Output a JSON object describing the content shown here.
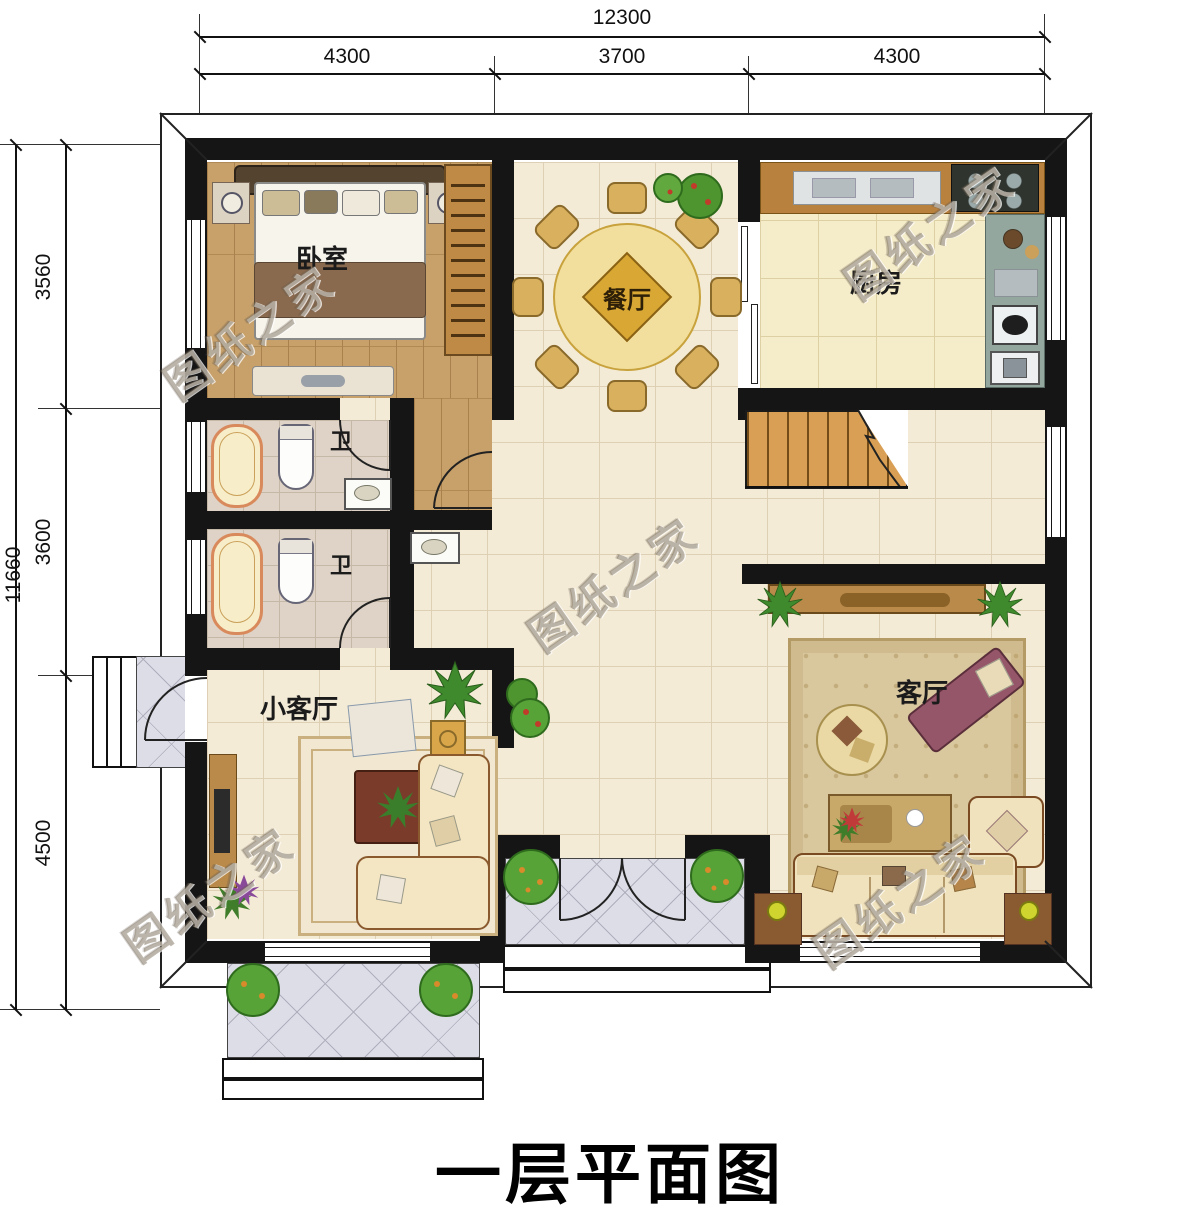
{
  "title": "一层平面图",
  "watermark_text": "图纸之家",
  "dimensions": {
    "top": {
      "total": "12300",
      "seg1": "4300",
      "seg2": "3700",
      "seg3": "4300"
    },
    "left": {
      "total": "11660",
      "seg1": "3560",
      "seg2": "3600",
      "seg3": "4500"
    }
  },
  "rooms": {
    "bedroom": "卧室",
    "dining": "餐厅",
    "kitchen": "厨房",
    "bath_upper": "卫",
    "bath_lower": "卫",
    "small_living": "小客厅",
    "living": "客厅"
  },
  "palette": {
    "wall": "#151515",
    "tile_floor": "#f4ebd7",
    "wood_floor": "#c7a06a",
    "porch_tile": "#dcdde6",
    "stair_wood": "#d9a055",
    "plant_green": "#4e9530"
  }
}
